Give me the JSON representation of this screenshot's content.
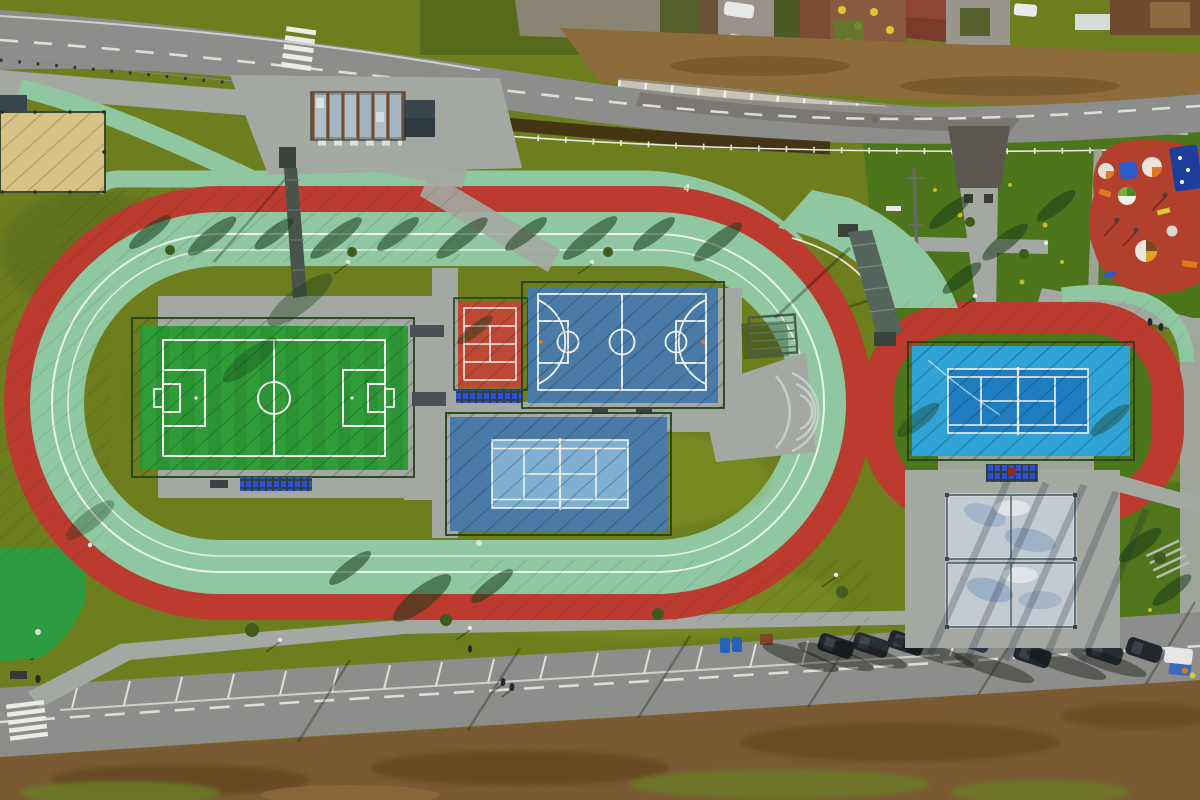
{
  "scene": {
    "track_lane_marker": "4"
  },
  "colors": {
    "grass_base": "#6e7d1e",
    "grass_dark": "#57691a",
    "grass_bright": "#8fa32b",
    "lawn_green": "#4c751c",
    "turf_green": "#2f9e38",
    "turf_stripe": "#27902f",
    "track_green": "#8fc7a0",
    "track_red": "#bb3b2f",
    "court_blue": "#4a7aa8",
    "court_blue_light": "#7fb0d4",
    "tennis_cyan": "#2fa3d6",
    "tennis_blue": "#1d7dc0",
    "court_red": "#bf4736",
    "sand": "#d9c185",
    "asphalt": "#8d8d8b",
    "asphalt_dark": "#5b564e",
    "path_gray": "#a4a8a2",
    "concrete": "#c6c2b6",
    "dirt": "#7a5a33",
    "dirt_dark": "#5d431f",
    "dirt_light": "#8d6b3a",
    "playground_red": "#b2402c",
    "bench_blue": "#2a4fd4",
    "line_white": "#f5f5f2",
    "fence_dark": "#24431b",
    "car_dark": "#20262c",
    "dumpster_blue": "#2563b8",
    "bright_green": "#2f9b40",
    "glass_gray": "#c3cad1",
    "accent_orange": "#e07820",
    "accent_yellow": "#d9c832"
  }
}
